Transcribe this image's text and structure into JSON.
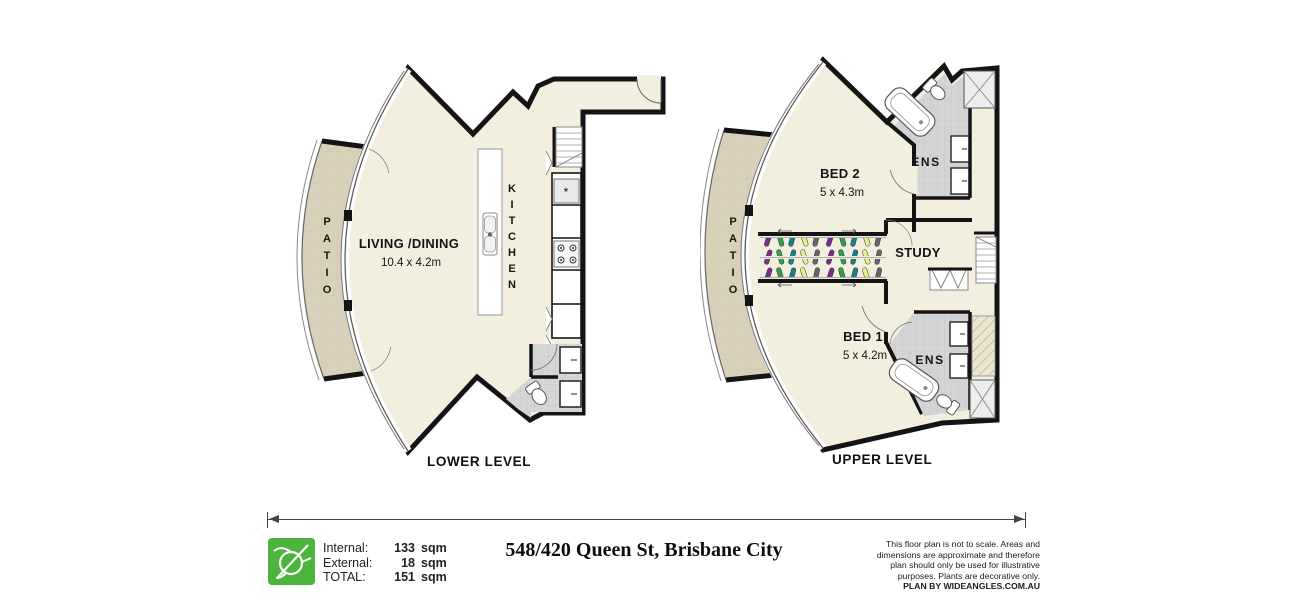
{
  "lower_plan": {
    "caption": "LOWER LEVEL",
    "living": {
      "name": "LIVING /DINING",
      "dims": "10.4 x 4.2m"
    },
    "kitchen_label": "KITCHEN",
    "patio_label": "PATIO",
    "microwave_glyph": "*"
  },
  "upper_plan": {
    "caption": "UPPER LEVEL",
    "bed2": {
      "name": "BED 2",
      "dims": "5 x 4.3m"
    },
    "bed1": {
      "name": "BED 1",
      "dims": "5 x 4.2m"
    },
    "study": {
      "name": "STUDY"
    },
    "ens_top_label": "ENS",
    "ens_bottom_label": "ENS",
    "patio_label": "PATIO"
  },
  "footer": {
    "areas": {
      "internal": {
        "label": "Internal:",
        "value": "133",
        "unit": "sqm"
      },
      "external": {
        "label": "External:",
        "value": "18",
        "unit": "sqm"
      },
      "total": {
        "label": "TOTAL:",
        "value": "151",
        "unit": "sqm"
      }
    },
    "title": "548/420 Queen St, Brisbane City",
    "disclaimer": "This floor plan is not to scale. Areas and dimensions are approximate and therefore plan should only be used for illustrative purposes. Plants are decorative only.",
    "brand": "PLAN BY WIDEANGLES.COM.AU"
  },
  "colors": {
    "floor": "#f3efdf",
    "patio": "#d9d0ba",
    "wall": "#141414",
    "tile": "#d4d4d4",
    "logo_green": "#4cb43c"
  }
}
